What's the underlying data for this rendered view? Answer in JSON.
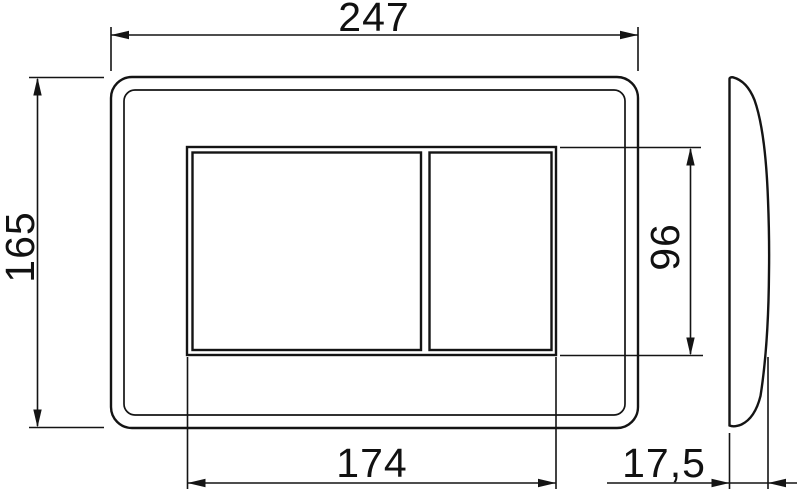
{
  "drawing": {
    "dimensions": {
      "plate_width": "247",
      "plate_height": "165",
      "button_area_width": "174",
      "button_area_height": "96",
      "plate_depth": "17,5"
    },
    "colors": {
      "line": "#141414",
      "background": "#ffffff"
    }
  }
}
